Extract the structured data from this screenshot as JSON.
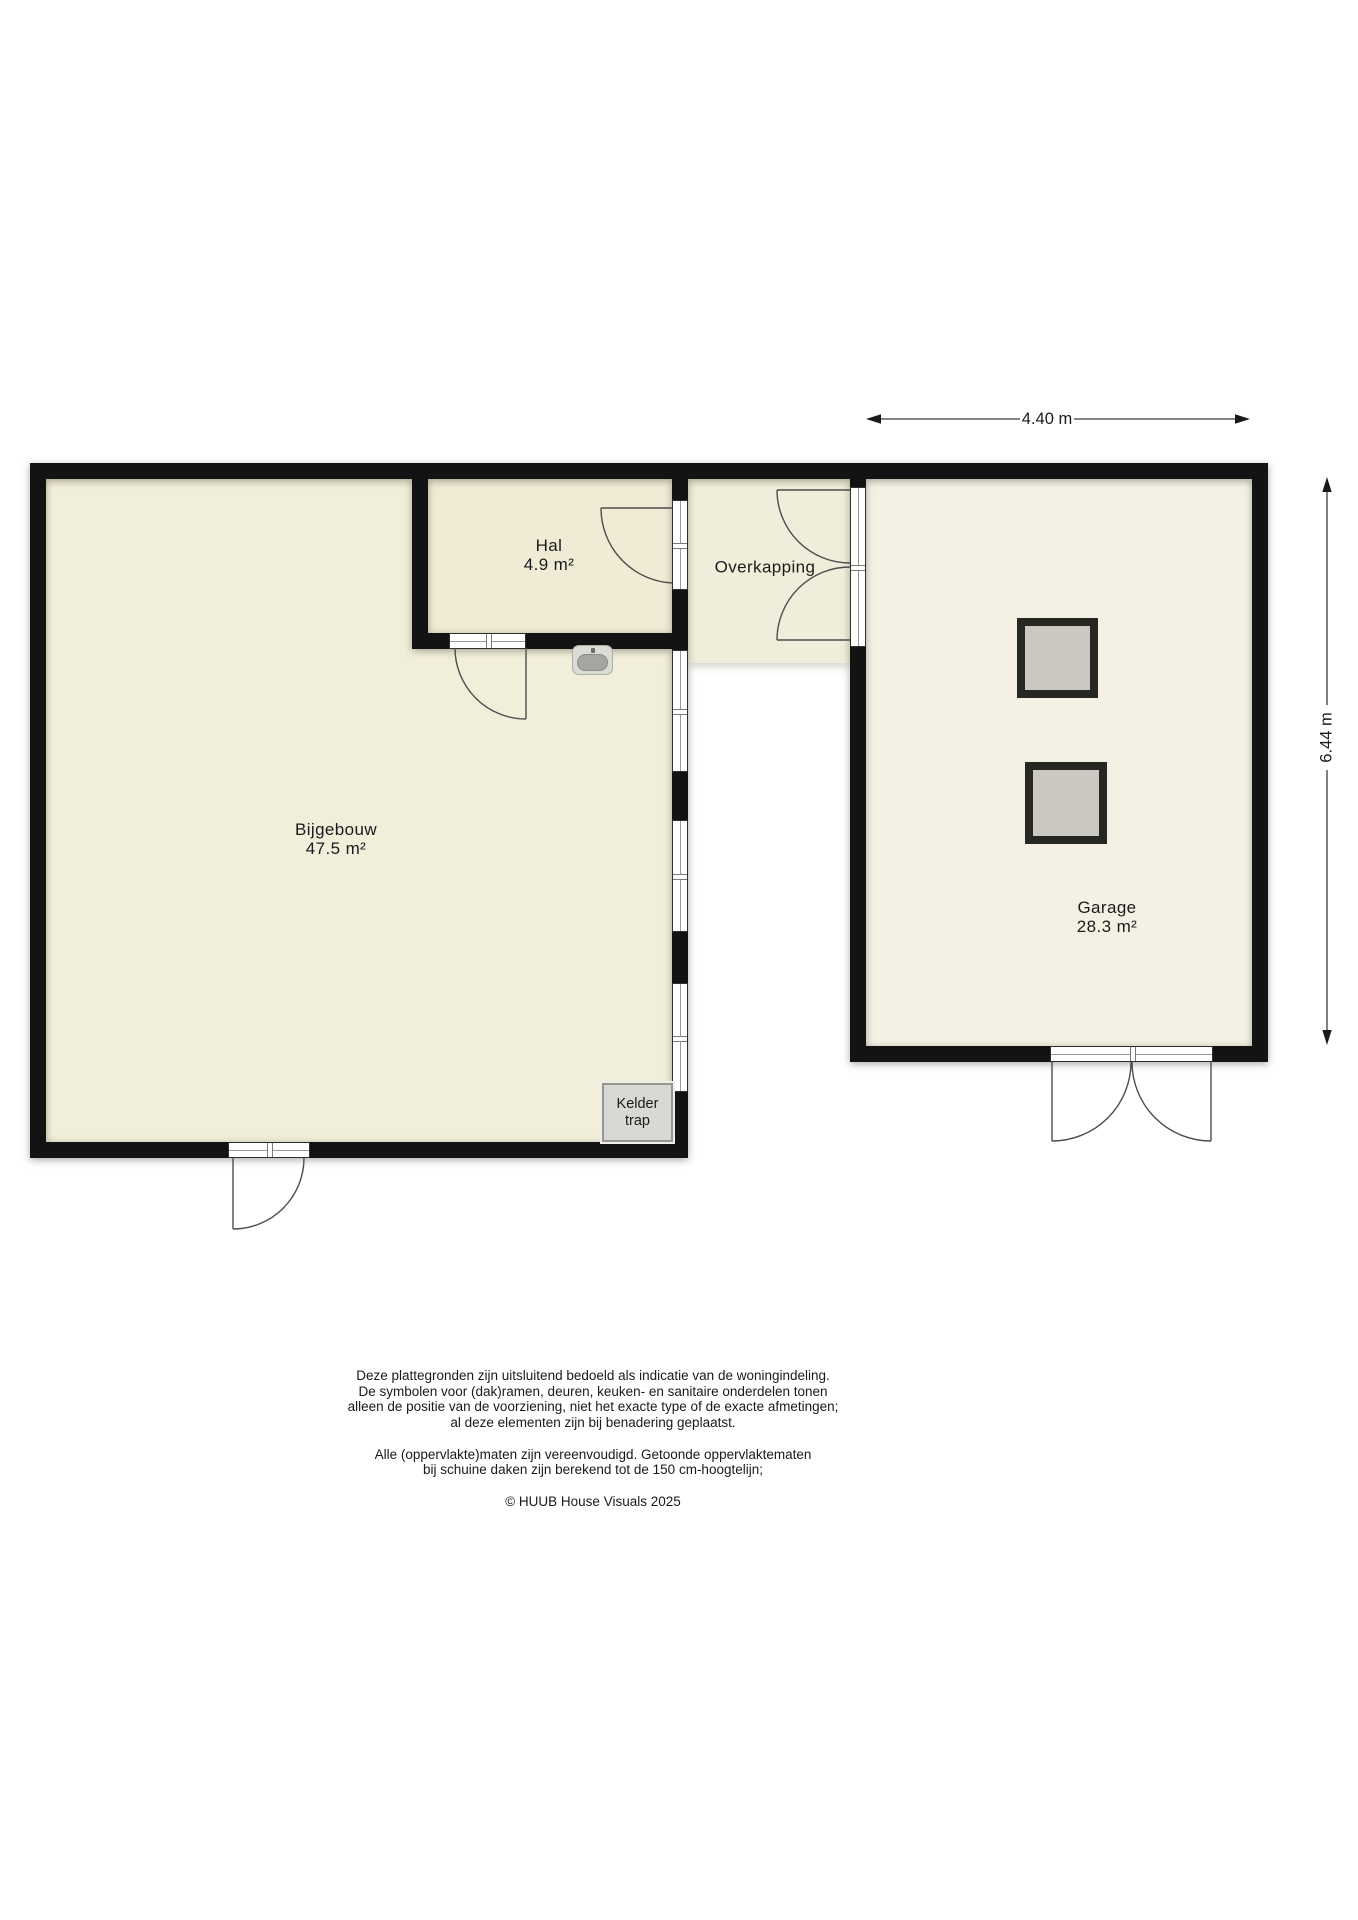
{
  "floorplan": {
    "rooms": {
      "bijgebouw": {
        "name": "Bijgebouw",
        "area": "47.5 m²"
      },
      "hal": {
        "name": "Hal",
        "area": "4.9 m²"
      },
      "overkapping": {
        "name": "Overkapping"
      },
      "garage": {
        "name": "Garage",
        "area": "28.3 m²"
      }
    },
    "stairs": {
      "line1": "Kelder",
      "line2": "trap"
    },
    "dimensions": {
      "top_label": "4.40 m",
      "right_label": "6.44 m"
    },
    "icons": {
      "sink": "sink-icon"
    },
    "colors": {
      "wall": "#131313",
      "floor_bijgebouw": "#f1eeda",
      "floor_hal": "#efebd5",
      "floor_overkapping": "#f0edda",
      "floor_garage": "#f4f1e4",
      "square_fill": "#cac8c1",
      "stairs_box_fill": "#d8d8d4"
    }
  },
  "footer": {
    "disclaimer_p1": [
      "Deze plattegronden zijn uitsluitend bedoeld als indicatie van de woningindeling.",
      "De symbolen voor (dak)ramen, deuren, keuken- en sanitaire onderdelen tonen",
      "alleen de positie van de voorziening, niet het exacte type of de exacte afmetingen;",
      "al deze elementen zijn bij benadering geplaatst."
    ],
    "disclaimer_p2": [
      "Alle (oppervlakte)maten zijn vereenvoudigd. Getoonde oppervlaktematen",
      "bij schuine daken zijn berekend tot de 150 cm-hoogtelijn;"
    ],
    "copyright": "© HUUB House Visuals 2025"
  }
}
